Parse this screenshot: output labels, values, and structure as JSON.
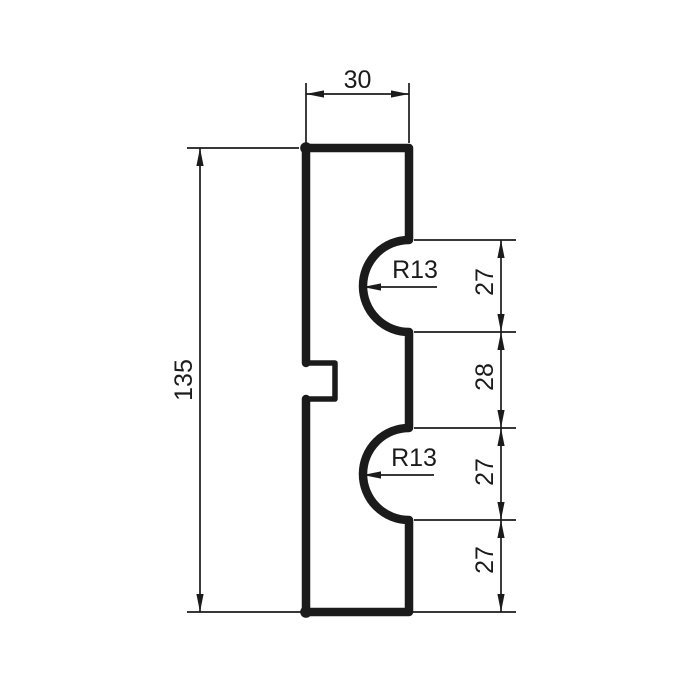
{
  "colors": {
    "line": "#1b1b1b",
    "background": "#ffffff"
  },
  "drawing": {
    "type": "technical-profile-cross-section",
    "labels": {
      "width_top": "30",
      "height_total": "135",
      "radius_upper": "R13",
      "radius_lower": "R13",
      "chain": [
        "27",
        "28",
        "27",
        "27"
      ]
    },
    "values": {
      "width_top": 30,
      "height_total": 135,
      "notch_radius": 13,
      "right_segments": [
        27,
        28,
        27,
        27
      ]
    }
  }
}
